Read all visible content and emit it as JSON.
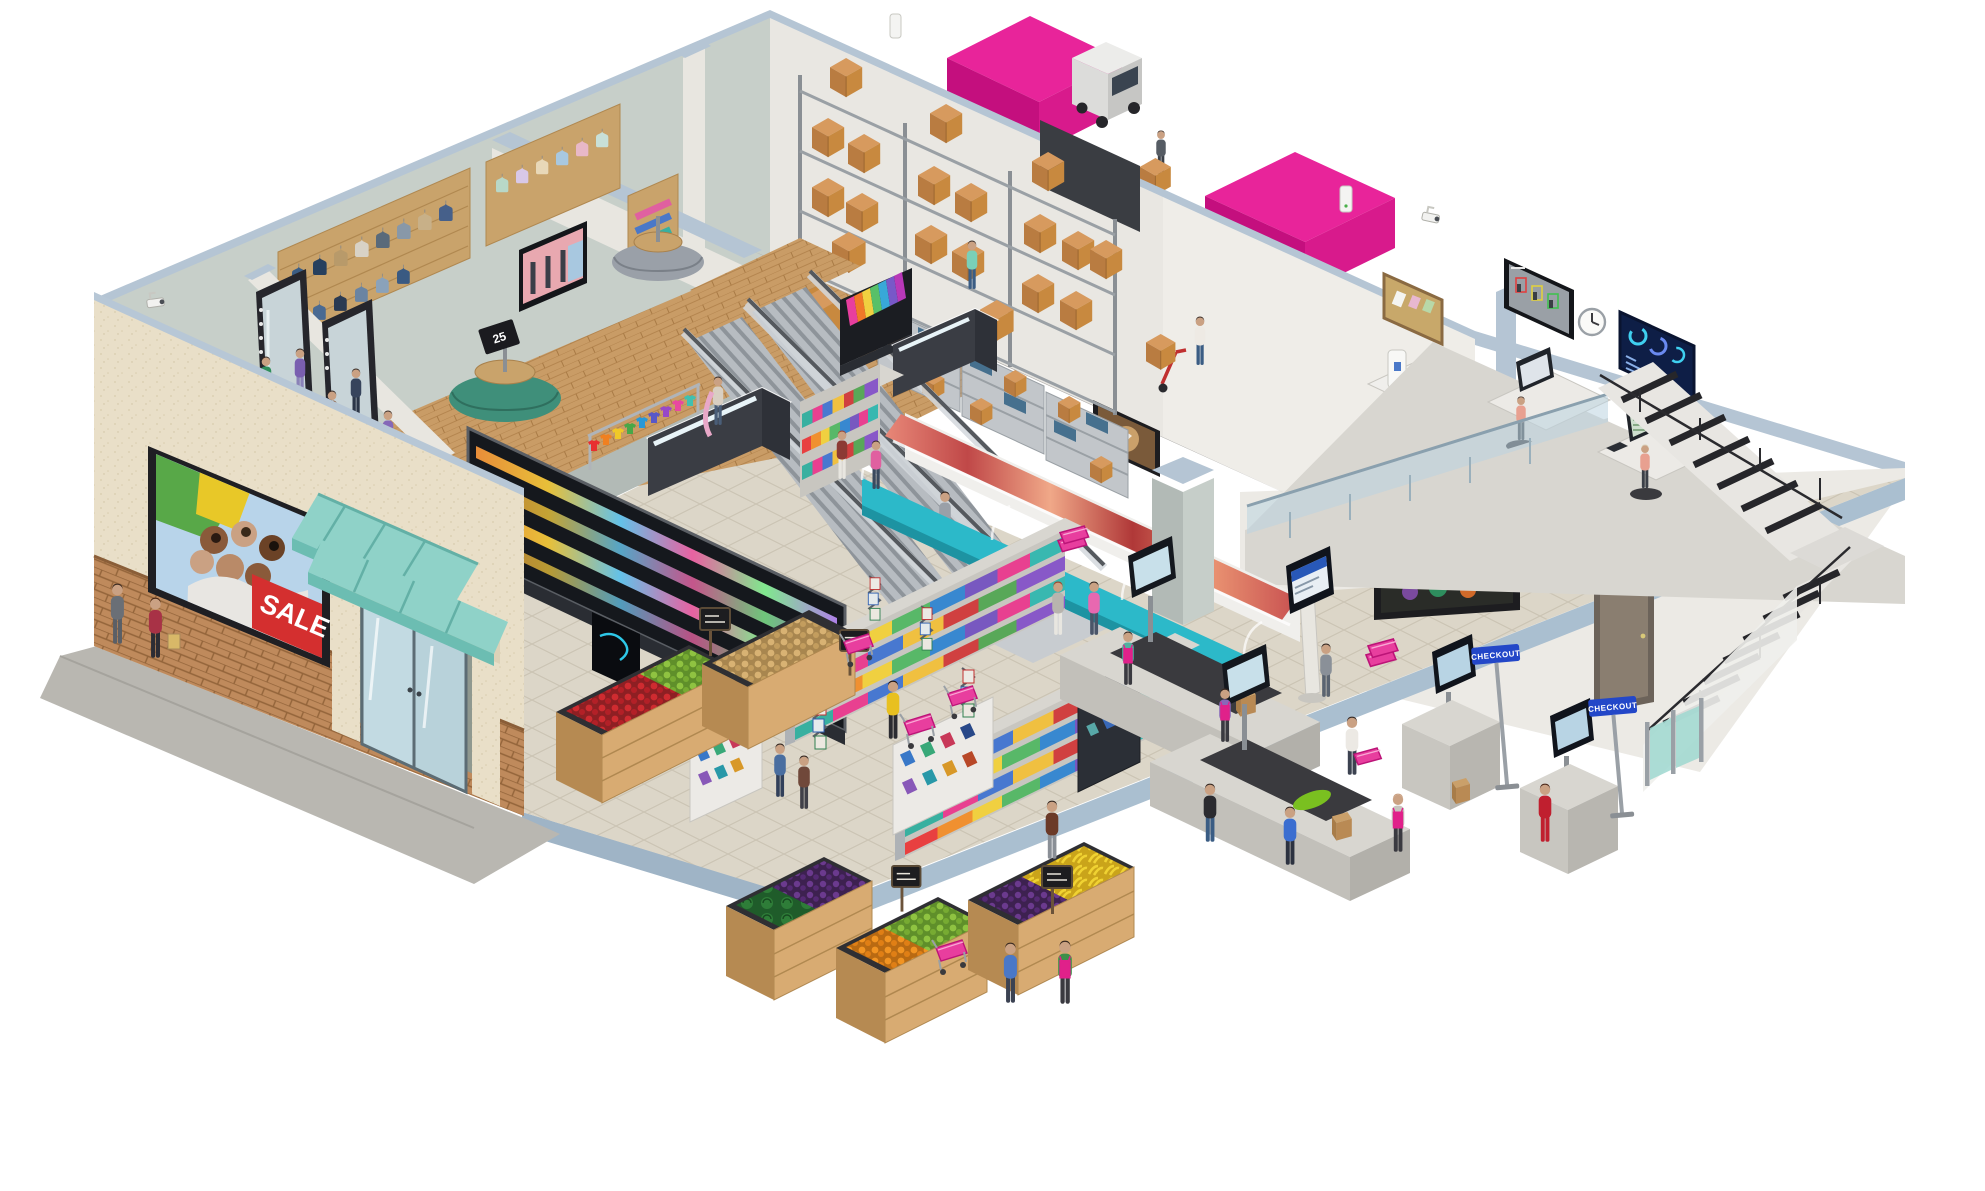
{
  "signs": {
    "billboard_sale": "SALE",
    "checkout_sign_a": "CHECKOUT",
    "checkout_sign_b": "CHECKOUT",
    "clothing_rack_price": "25"
  },
  "palette": {
    "brand_magenta": "#e8249a",
    "brand_magenta_dark": "#c40f7e",
    "apron_pink": "#e0218a",
    "awning_teal": "#8fd2c8",
    "deli_teal": "#2cb9c9",
    "wall_cut_edge": "#b5c5d4",
    "interior_wall": "#c7cfc9",
    "office_wall": "#efede8",
    "facade_stucco": "#e9dfc8",
    "brick": "#bf8a5c",
    "wood_floor": "#c99c66",
    "tile_floor": "#dcd6c8",
    "concrete": "#a8a6a2",
    "cardboard": "#c8893f",
    "sign_blue": "#2347c8"
  },
  "scene_elements": [
    "sale-billboard",
    "entrance-doors",
    "clothing-department",
    "fitting-mirrors",
    "round-clothing-racks",
    "warehouse-pallet-racks",
    "stock-shelving",
    "hand-truck",
    "delivery-trailers",
    "truck-cab",
    "office-cctv-monitor",
    "office-wall-clock",
    "office-dashboard-screen",
    "office-desks",
    "cork-board",
    "escalators",
    "deli-counter",
    "grocery-gondolas",
    "drinks-fridge",
    "info-kiosk",
    "magazine-racks",
    "media-display",
    "produce-bins",
    "chalkboard-price-signs",
    "checkout-lanes",
    "self-checkout-kiosks",
    "checkout-signs",
    "entry-gates",
    "shopping-carts",
    "shopping-baskets",
    "security-cameras",
    "stairs"
  ]
}
